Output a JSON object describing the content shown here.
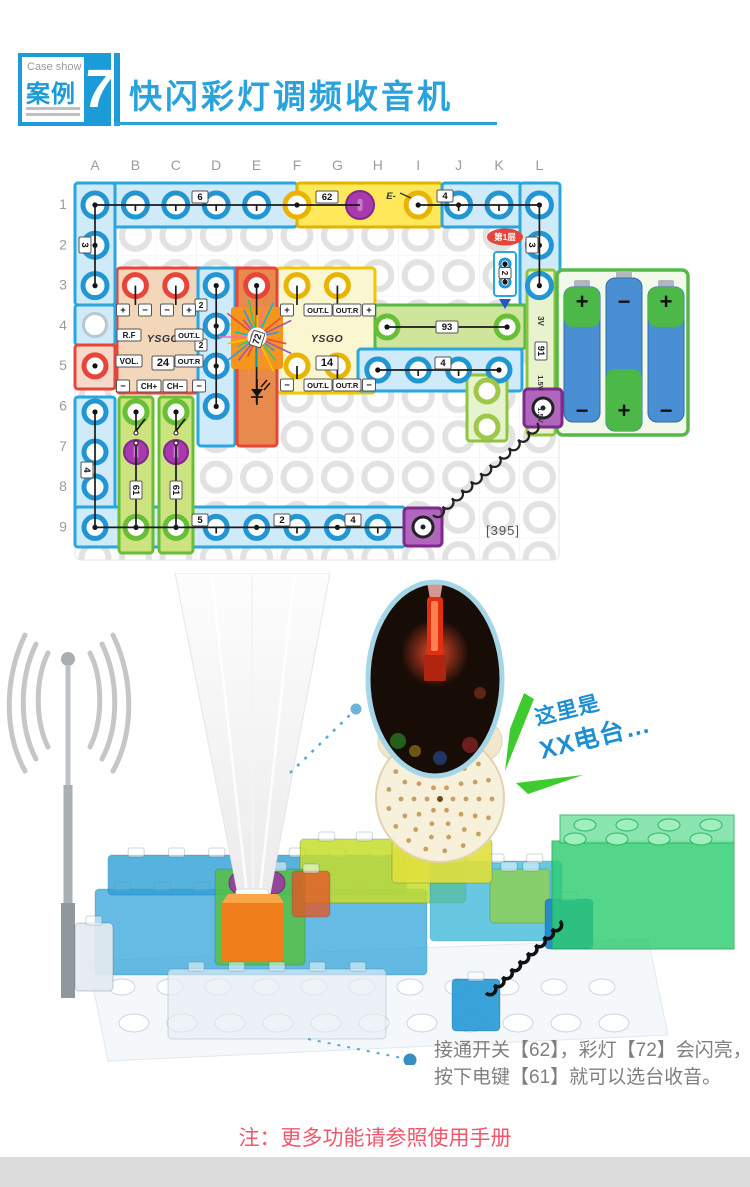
{
  "header": {
    "eyebrow": "Case show",
    "case_label": "案例",
    "case_number": "7",
    "title": "快闪彩灯调频收音机"
  },
  "diagram": {
    "columns": [
      "A",
      "B",
      "C",
      "D",
      "E",
      "F",
      "G",
      "H",
      "I",
      "J",
      "K",
      "L"
    ],
    "rows": [
      "1",
      "2",
      "3",
      "4",
      "5",
      "6",
      "7",
      "8",
      "9"
    ],
    "layer_badge": "第1层",
    "part_number": "[395]",
    "chips": {
      "top6": "6",
      "top62": "62",
      "e_mark": "E-",
      "top4": "4",
      "right3": "3",
      "left3": "3",
      "k2": "2",
      "d2a": "2",
      "d2b": "2",
      "m24_p1": "+",
      "m24_m1": "−",
      "m24_m2": "−",
      "m24_p2": "+",
      "m24_rf": "R.F",
      "m24_vol": "VOL.",
      "m24_brand": "YSGO",
      "m24_no": "24",
      "m24_outl": "OUT.L",
      "m24_outr": "OUT.R",
      "m24_bm1": "−",
      "m24_chp": "CH+",
      "m24_chm": "CH−",
      "m24_bm2": "−",
      "m14_p1": "+",
      "m14_outl": "OUT.L",
      "m14_outr": "OUT.R",
      "m14_p2": "+",
      "m14_brand": "YSGO",
      "m14_no": "14",
      "m14_bm1": "−",
      "m14_boutl": "OUT.L",
      "m14_boutr": "OUT.R",
      "m14_bm2": "−",
      "spk93": "93",
      "row5_4": "4",
      "bat91": "91",
      "bat_3v": "3V",
      "bat_15a": "1.5V",
      "bat_15b": "1.5V",
      "key61a": "61",
      "key61b": "61",
      "left4": "4",
      "row9_5": "5",
      "row9_2": "2",
      "row9_4": "4",
      "light72": "72"
    },
    "battery_signs_top": [
      "+",
      "−",
      "+"
    ],
    "battery_signs_bottom": [
      "−",
      "+",
      "−"
    ]
  },
  "photo": {
    "callout_line1": "这里是",
    "callout_line2": "XX电台…"
  },
  "notes": {
    "instruction_line1": "接通开关【62】，彩灯【72】会闪亮，",
    "instruction_line2": "按下电键【61】就可以选台收音。",
    "manual_note": "注：更多功能请参照使用手册"
  }
}
